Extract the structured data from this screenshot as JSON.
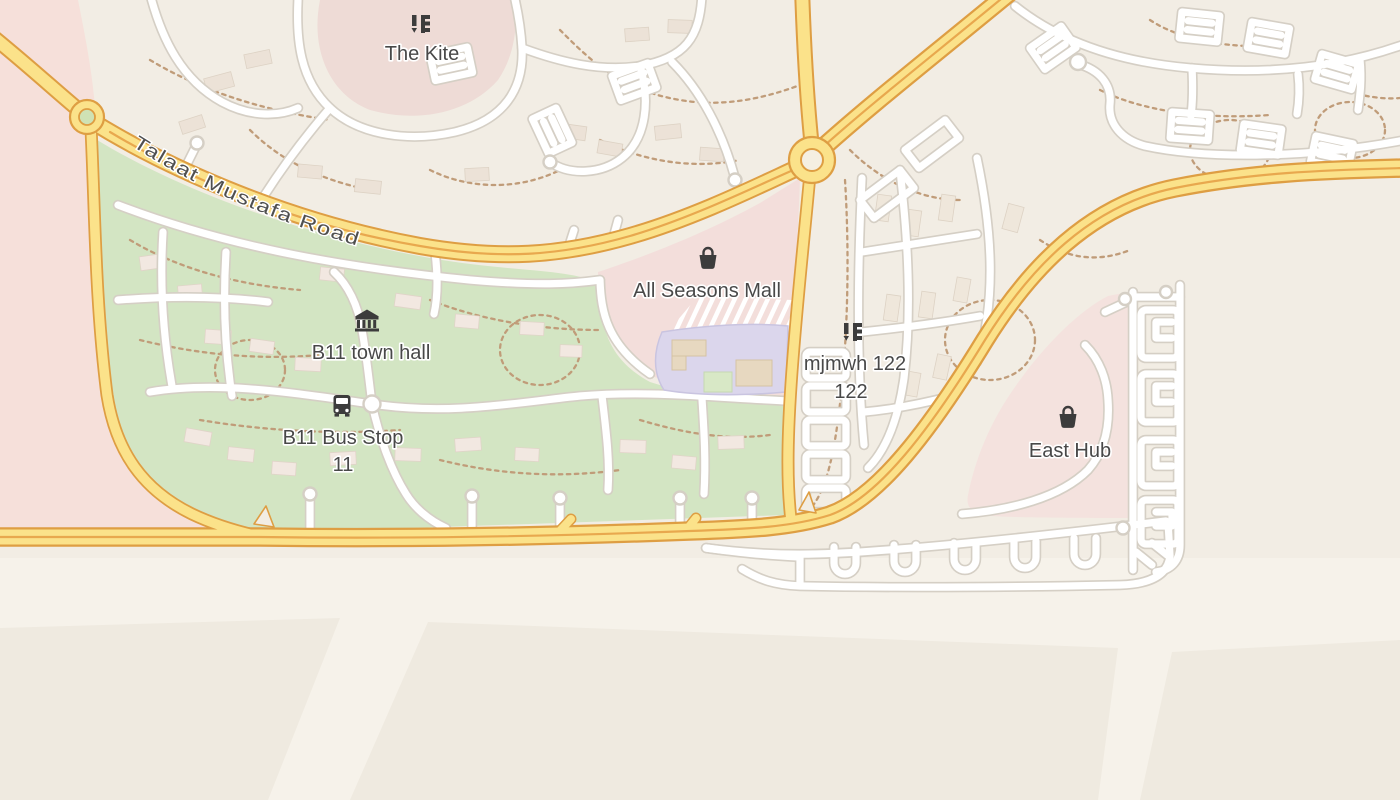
{
  "map": {
    "road_label": {
      "name": "Talaat Mustafa Road"
    },
    "pois": [
      {
        "id": "the-kite",
        "label": "The Kite",
        "icon": "apartments-icon"
      },
      {
        "id": "all-seasons-mall",
        "label": "All Seasons Mall",
        "icon": "shopping-bag-icon"
      },
      {
        "id": "b11-town-hall",
        "label": "B11 town hall",
        "icon": "town-hall-icon"
      },
      {
        "id": "b11-bus-stop",
        "label_line1": "B11 Bus Stop",
        "label_line2": "11",
        "icon": "bus-icon"
      },
      {
        "id": "mjmwh-122",
        "label_line1": "mjmwh 122",
        "label_line2": "122",
        "icon": "apartments-icon"
      },
      {
        "id": "east-hub",
        "label": "East Hub",
        "icon": "shopping-bag-icon"
      }
    ],
    "colors": {
      "land_base": "#f2ede4",
      "land_bottom": "#f6f2ea",
      "parcel": "#efeae0",
      "residential_pink_west": "#f6e0da",
      "kite_pink": "#eedbd6",
      "mall_pink": "#f3dedb",
      "east_hub_pink": "#f4e2de",
      "green_area": "#d3e5c3",
      "road_yellow": "#fbe28a",
      "road_casing_orange": "#de9e43",
      "road_median_orange": "#e8a84e",
      "minor_road": "#ffffff",
      "minor_casing": "#d5cfc5",
      "dashed_path": "#c09c79",
      "building_lavender": "#dbd6ec",
      "roundabout_island_green": "#cfe2b4",
      "label_text": "#484848"
    }
  }
}
